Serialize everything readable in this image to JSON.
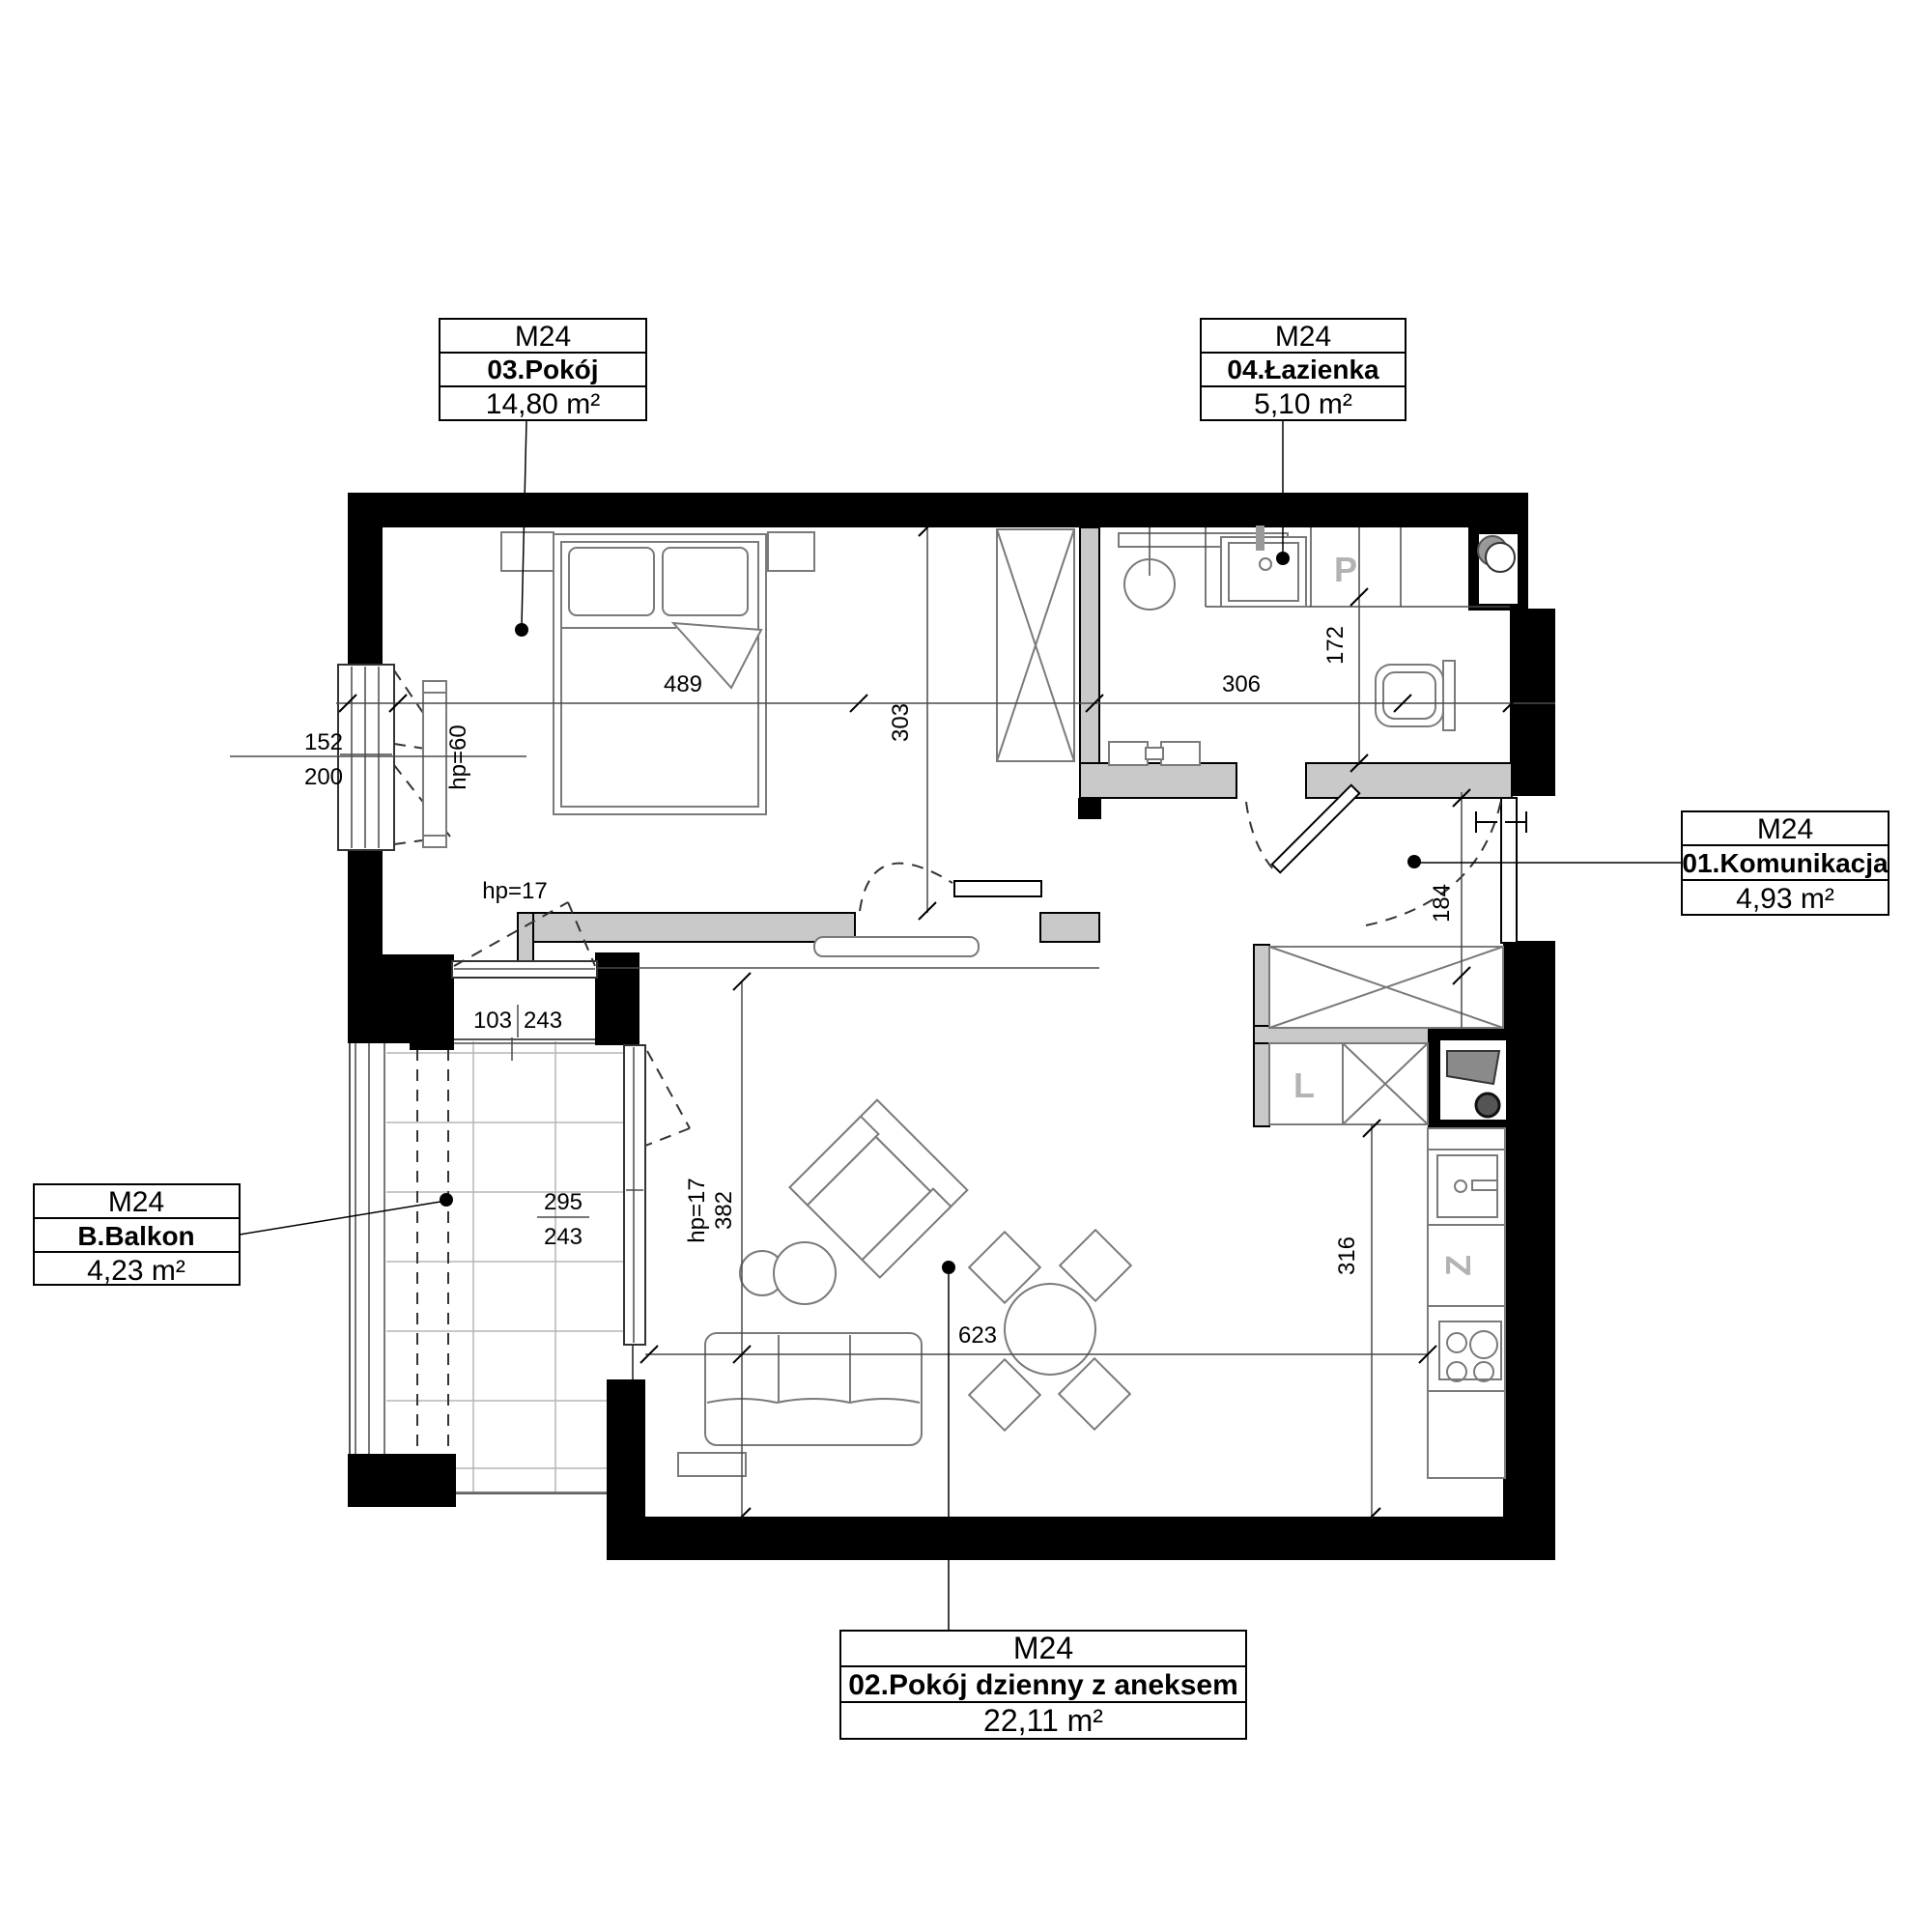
{
  "unit_labels": {
    "pokoj": {
      "unit": "M24",
      "name": "03.Pokój",
      "area": "14,80 m²"
    },
    "lazienka": {
      "unit": "M24",
      "name": "04.Łazienka",
      "area": "5,10 m²"
    },
    "komunikacja": {
      "unit": "M24",
      "name": "01.Komunikacja",
      "area": "4,93 m²"
    },
    "balkon": {
      "unit": "M24",
      "name": "B.Balkon",
      "area": "4,23 m²"
    },
    "dzienny": {
      "unit": "M24",
      "name": "02.Pokój dzienny z aneksem",
      "area": "22,11 m²"
    }
  },
  "dims": {
    "bedroom_width": "489",
    "bedroom_depth": "303",
    "bathroom_width": "306",
    "bathroom_depth": "172",
    "hallway_depth": "184",
    "living_depth": "382",
    "living_width": "623",
    "kitchen_run": "316",
    "bedroom_window_width": "152",
    "bedroom_window_height": "200",
    "balcony_window_width": "103",
    "balcony_window_height": "243",
    "balcony_door_width": "295",
    "balcony_door_height": "243",
    "bedroom_window_sill": "hp=60",
    "balcony_window_sill": "hp=17",
    "balcony_door_sill": "hp=17"
  },
  "fixtures": {
    "washing_machine": "P",
    "fridge": "L",
    "dishwasher": "Z"
  },
  "colors": {
    "wall": "#000000",
    "partition_fill": "#c9c9c9",
    "furniture_line": "#7a7a7a",
    "fixture_letter": "#b3b3b3"
  }
}
